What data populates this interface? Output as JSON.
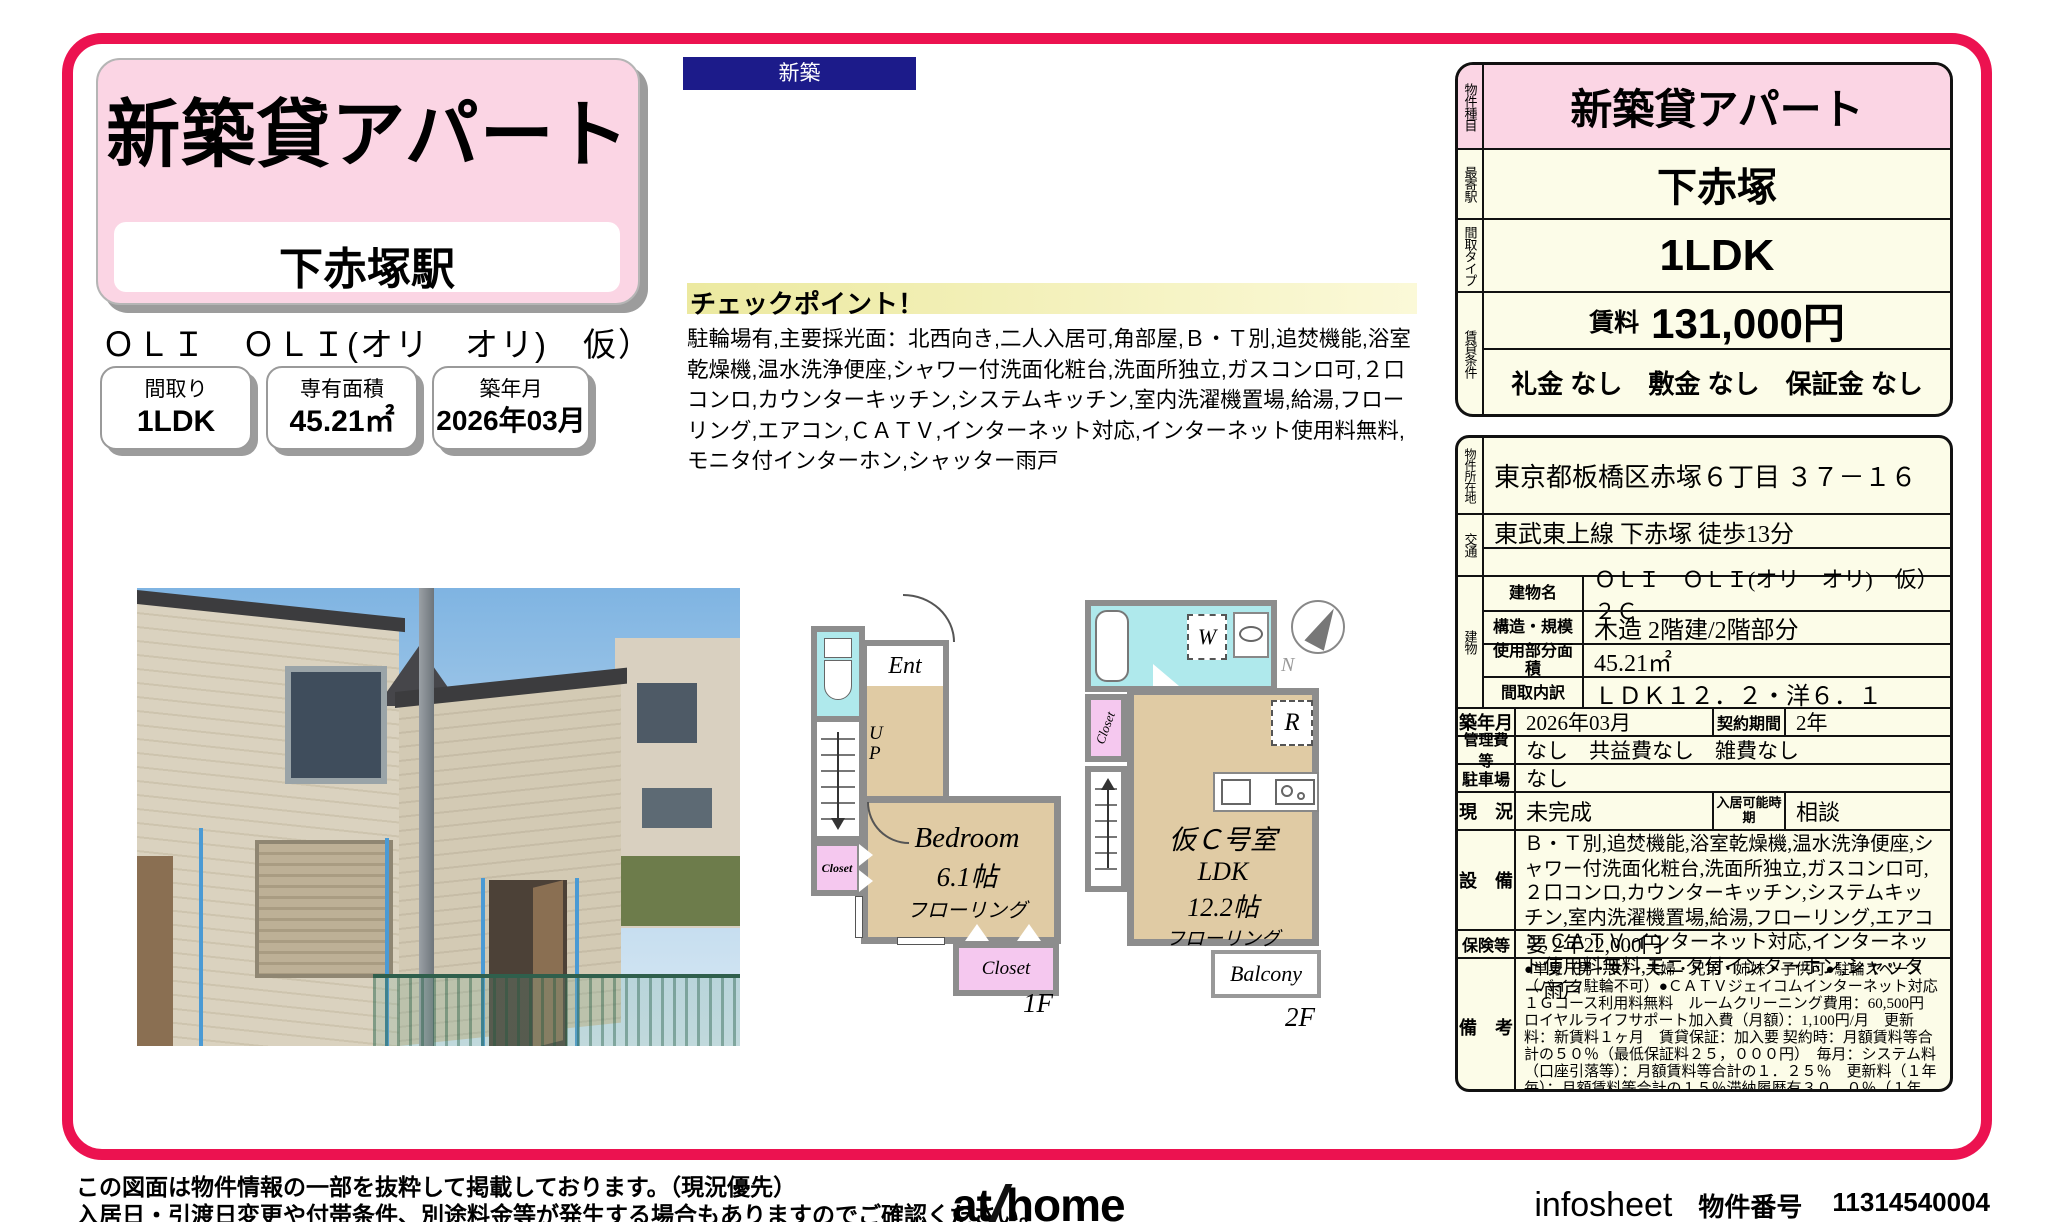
{
  "colors": {
    "frame_red": "#ec1250",
    "pink": "#fbd5e4",
    "cream": "#fcfce8",
    "navy": "#1c1b8a",
    "plan_tan": "#e0cba4",
    "plan_cyan": "#afe9ec",
    "plan_pink": "#f5c8ef"
  },
  "header": {
    "title": "新築貸アパート",
    "station": "下赤塚駅",
    "building_code": "ＯＬＩ　ＯＬＩ(オリ　オリ)　仮）２Ｃ",
    "stats": [
      {
        "label": "間取り",
        "value": "1LDK"
      },
      {
        "label": "専有面積",
        "value": "45.21㎡"
      },
      {
        "label": "築年月",
        "value": "2026年03月"
      }
    ]
  },
  "badge": "新築",
  "checkpoint": {
    "heading": "チェックポイント！",
    "body": "駐輪場有,主要採光面：北西向き,二人入居可,角部屋,Ｂ・Ｔ別,追焚機能,浴室乾燥機,温水洗浄便座,シャワー付洗面化粧台,洗面所独立,ガスコンロ可,２口コンロ,カウンターキッチン,システムキッチン,室内洗濯機置場,給湯,フローリング,エアコン,ＣＡＴＶ,インターネット対応,インターネット使用料無料,モニタ付インターホン,シャッター雨戸"
  },
  "summary_table": {
    "type_label": "物件種目",
    "type": "新築貸アパート",
    "station_label": "最寄駅",
    "station": "下赤塚",
    "layout_label": "間取タイプ",
    "layout": "1LDK",
    "terms_label": "賃貸条件",
    "rent_label": "賃料",
    "rent": "131,000円",
    "deposits": "礼金 なし　敷金 なし　保証金 なし"
  },
  "detail_table": {
    "location_label": "物件所在地",
    "location": "東京都板橋区赤塚６丁目 ３７－１６",
    "access_label": "交通",
    "access": "東武東上線 下赤塚 徒歩13分",
    "building_label": "建物",
    "building_rows": [
      {
        "label": "建物名",
        "value": "ＯＬＩ　ＯＬＩ(オリ　オリ)　仮）２Ｃ"
      },
      {
        "label": "構造・規模",
        "value": "木造 2階建/2階部分"
      },
      {
        "label": "使用部分面積",
        "value": "45.21㎡"
      },
      {
        "label": "間取内訳",
        "value": "ＬＤＫ１２．２・洋６．１"
      }
    ],
    "built_label": "築年月",
    "built": "2026年03月",
    "contract_label": "契約期間",
    "contract": "2年",
    "fees_label": "管理費等",
    "fees": "なし　共益費なし　雑費なし",
    "parking_label": "駐車場",
    "parking": "なし",
    "status_label": "現　況",
    "status": "未完成",
    "movein_label": "入居可能時期",
    "movein": "相談",
    "equipment_label": "設　備",
    "equipment": "Ｂ・Ｔ別,追焚機能,浴室乾燥機,温水洗浄便座,シャワー付洗面化粧台,洗面所独立,ガスコンロ可,２口コンロ,カウンターキッチン,システムキッチン,室内洗濯機置場,給湯,フローリング,エアコン,ＣＡＴＶ,インターネット対応,インターネット使用料無料,モニタ付インターホン,シャッター雨戸",
    "insurance_label": "保険等",
    "insurance": "要 2年22,000円",
    "notes_label": "備　考",
    "notes": "●単身（男・女）・夫婦・兄弟・姉妹・子供可●駐輪スペース（バイク駐輪不可）●ＣＡＴＶジェイコムインターネット対応　１Ｇコース利用料無料　ルームクリーニング費用：60,500円　ロイヤルライフサポート加入費（月額）：1,100円/月　更新料：新賃料１ヶ月　賃貸保証：加入要 契約時：月額賃料等合計の５０％（最低保証料２５，０００円）　毎月：システム料（口座引落等）：月額賃料等合計の１．２５％　更新料（１年毎）：月額賃料等合計の１５％滞納履歴有３０．０％（１年毎）　　利用駅１：東京メトロ有楽町線 地下鉄赤塚 徒歩13分　利用駅２：東武東上線 成増 徒歩15分"
  },
  "floorplan_1f": {
    "ent": "Ent",
    "up1": "U",
    "up2": "P",
    "closet1": "Closet",
    "room": "Bedroom",
    "size": "6.1帖",
    "floor": "フローリング",
    "closet2": "Closet",
    "label": "1F"
  },
  "floorplan_2f": {
    "w": "W",
    "r": "R",
    "closet": "Closet",
    "dn1": "D",
    "dn2": "N",
    "room_name": "仮Ｃ号室",
    "room_type": "LDK",
    "size": "12.2帖",
    "floor": "フローリング",
    "balcony": "Balcony",
    "label": "2F",
    "north": "N"
  },
  "footer": {
    "disclaimer1": "この図面は物件情報の一部を抜粋して掲載しております。（現況優先）",
    "disclaimer2": "入居日・引渡日変更や付帯条件、別途料金等が発生する場合もありますのでご確認ください。",
    "logo_at": "at",
    "logo_home": "home",
    "sheet_name": "infosheet",
    "property_no_label": "物件番号",
    "property_no": "11314540004"
  }
}
